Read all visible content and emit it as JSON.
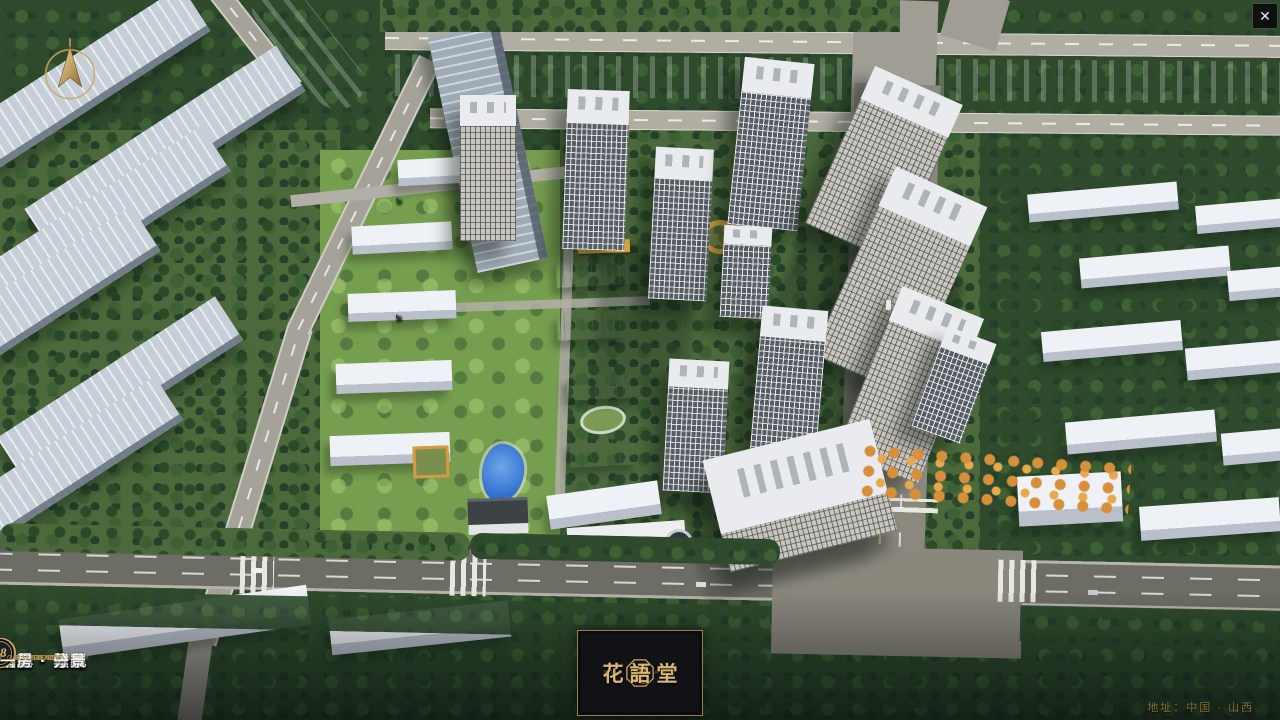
{
  "colors": {
    "gold": "#c8a565",
    "caption_gold": "#b08f47",
    "bar_bg": "#14171a",
    "label_white": "#f3f3f0",
    "address_gold": "#7e7036",
    "river_blue": "#2f66c8"
  },
  "icons": {
    "close": "✕",
    "compass": "gold-north-arrow",
    "brand_seal": "octagonal-seal",
    "nav_badge": "double-ring-circle"
  },
  "navbar": {
    "items": [
      {
        "num": "o1",
        "label": "品牌 · 介绍",
        "caption": "BRAND SUPPORT"
      },
      {
        "num": "o2",
        "label": "区位 · 价值",
        "caption": "LOCATION VALUE"
      },
      {
        "num": "o3",
        "label": "项目 · 概况",
        "caption": "PROJECT SURVEY"
      },
      {
        "num": "o4",
        "label": "建筑 · 鉴赏",
        "caption": "APPRECIATION"
      },
      {
        "num": "o5",
        "label": "园林 · 景观",
        "caption": "GARDEN STREET"
      },
      {
        "num": "o6",
        "label": "精装 · 体验",
        "caption": "EXPERIENCE"
      },
      {
        "num": "o7",
        "label": "户型 · 分布",
        "caption": "SHOW ROOM"
      },
      {
        "num": "o8",
        "label": "一房 · 一景",
        "caption": "COMMUNITY"
      }
    ],
    "brand": {
      "name": "花語堂",
      "tagline": "HUA YU TANG"
    },
    "address": "地址：中国 · 山西"
  }
}
